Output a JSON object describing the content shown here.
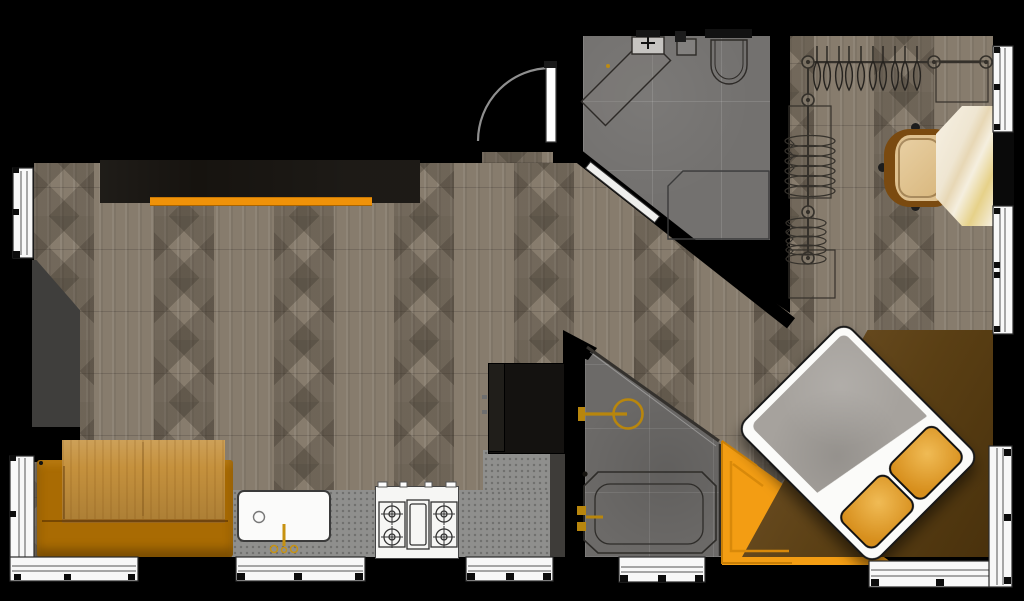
{
  "meta": {
    "type": "floor-plan",
    "view": "top-down-render",
    "canvas_w": 1024,
    "canvas_h": 601
  },
  "palette": {
    "outside_walls": "#000000",
    "wood_floor": "#877c6d",
    "bathroom_tile": "#73716f",
    "accent_orange": "#f39d13",
    "orange_bar": "#ef9209",
    "sofa": "#a96b03",
    "table_wood": "#c5913d",
    "counter_grey": "#8f8f8d",
    "tall_cabinet": "#141210",
    "gold_fixtures": "#b8860d",
    "bed_frame_white": "#fbfbf9",
    "duvet_grey": "#a6a29d",
    "pillow_orange": "#d78f1d",
    "platform_brown": "#5a3f14",
    "marble_desk": "#f2ebdb",
    "chair_seat": "#dfc18f",
    "chair_frame": "#7a4a10",
    "dark_panel_grey": "#3f3e3c"
  },
  "rooms": [
    {
      "name": "living-kitchen-area",
      "items": [
        "wall-cabinet-with-orange-bar",
        "dark-accent-panel",
        "orange-sofa",
        "wood-table",
        "kitchen-counter",
        "kitchen-sink",
        "gas-stove",
        "tall-dark-cabinet"
      ]
    },
    {
      "name": "bathroom-top",
      "items": [
        "angled-vanity",
        "wash-basin",
        "wall-fixture",
        "toilet",
        "shower-enclosure",
        "diagonal-sliding-door"
      ]
    },
    {
      "name": "bathroom-bottom",
      "items": [
        "gold-shower-head",
        "bathtub",
        "gold-tub-faucet"
      ]
    },
    {
      "name": "walk-in-closet",
      "items": [
        "hanger-rail-top",
        "hanger-rail-side",
        "folded-clothes-stacks",
        "shelf-boxes",
        "marble-desk",
        "office-chair"
      ]
    },
    {
      "name": "bedroom",
      "items": [
        "rotated-double-bed",
        "grey-duvet",
        "orange-pillows",
        "triangular-orange-rug",
        "brown-wood-platform"
      ]
    }
  ],
  "openings": {
    "entry_door": "swing-door-top-center",
    "window_segments": 10
  }
}
